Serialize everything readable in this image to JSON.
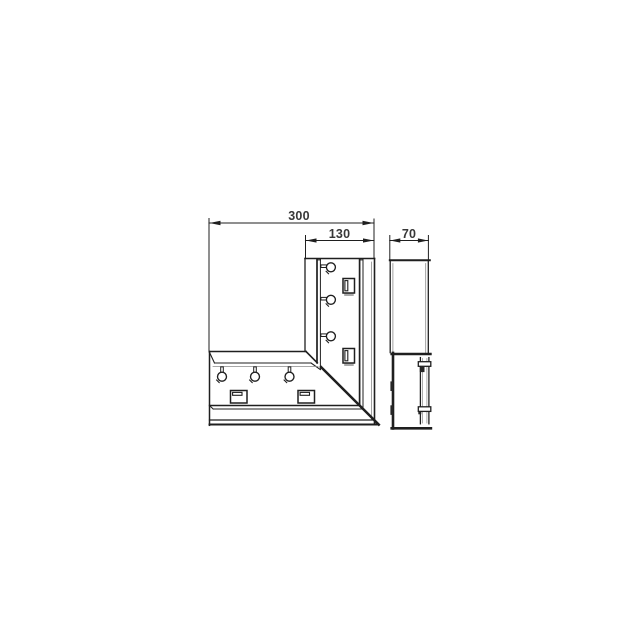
{
  "page": {
    "background_color": "#ffffff",
    "content_type": "technical line drawing"
  },
  "drawing": {
    "subject": "90-degree flat corner piece with mitered joint, shown in front view and side profile view",
    "dimensions": {
      "overall_length": "300",
      "arm_width": "130",
      "depth": "70"
    },
    "features": {
      "front_view": "L-shaped corner body with inner flange band, retaining pins and mounting clips, diagonal miter seam to outer corner",
      "side_view": "profile with upper cover section and lower base section with rail and clip bars"
    },
    "colors": {
      "line": "#1f1f1f",
      "dimension_text": "#383838",
      "shading": "#a9a9a9",
      "background": "#ffffff"
    }
  }
}
